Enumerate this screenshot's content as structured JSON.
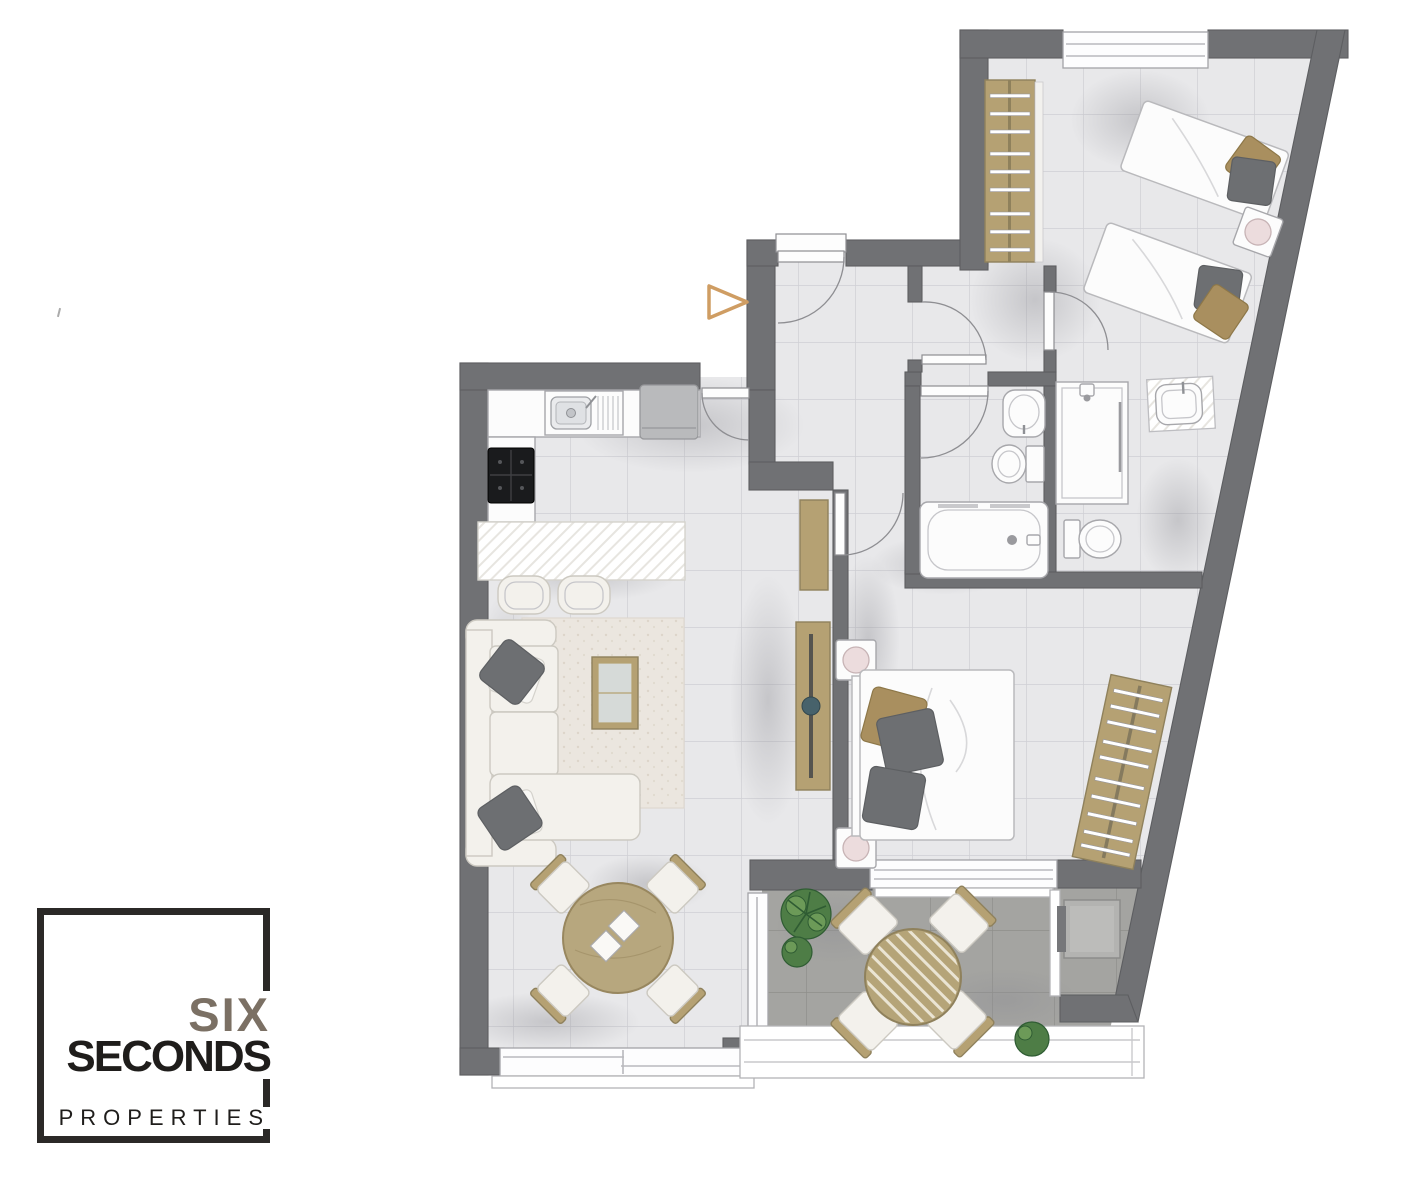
{
  "meta": {
    "width": 1410,
    "height": 1182,
    "background": "#ffffff",
    "kind": "apartment-floor-plan"
  },
  "logo": {
    "six": "SIX",
    "seconds": "SECONDS",
    "properties": "PROPERTIES"
  },
  "palette": {
    "wall": "#707174",
    "wallEdge": "#5d5e61",
    "floor": "#e8e8ea",
    "floorGrout": "#cfcfd4",
    "terraceFloor": "#a4a4a1",
    "terraceGrout": "#8f8f8b",
    "wood": "#b5a173",
    "woodEdge": "#8f815c",
    "fixture": "#fcfcfc",
    "fixtureLine": "#a7a7ab",
    "fabric": "#f3f1ec",
    "fabricLine": "#ccc9c1",
    "pillow": "#6d6f72",
    "pillowTan": "#a98f5f",
    "rug": "#ebe6df",
    "plant": "#4e7d46",
    "plantDark": "#2f5c33",
    "appliance": "#b9babc",
    "hob": "#1a1b1d",
    "lamp": "#ecdcdd",
    "duvetLine": "#d8d8da",
    "shadow": "#8d8d93",
    "arrow": "#cf9d63",
    "logoBorder": "#2b2927",
    "logoSix": "#7b7064",
    "logoText": "#1f1d1b"
  },
  "entrance_marker": {
    "icon": "triangle-right-icon",
    "color": "#cf9d63"
  },
  "rooms": [
    {
      "name": "kitchen"
    },
    {
      "name": "living-dining-room"
    },
    {
      "name": "corridor"
    },
    {
      "name": "entrance-vestibule"
    },
    {
      "name": "twin-bedroom"
    },
    {
      "name": "master-bedroom"
    },
    {
      "name": "bathroom-1"
    },
    {
      "name": "bathroom-2"
    },
    {
      "name": "terrace"
    }
  ],
  "furniture_legend": [
    {
      "name": "kitchen-sink",
      "shape": "basin-with-drainer"
    },
    {
      "name": "refrigerator",
      "shape": "gray-rect"
    },
    {
      "name": "cooktop",
      "shape": "black-rect-4-burners"
    },
    {
      "name": "kitchen-island",
      "shape": "white-hatched-rect"
    },
    {
      "name": "bar-stool",
      "count": 2
    },
    {
      "name": "sofa",
      "shape": "l-shaped-chaise"
    },
    {
      "name": "throw-pillow",
      "count": 4
    },
    {
      "name": "rug",
      "shape": "speckled-rect"
    },
    {
      "name": "coffee-table",
      "shape": "wood-frame-glass-top"
    },
    {
      "name": "dining-table",
      "shape": "round-wood",
      "chairs": 4
    },
    {
      "name": "console-table",
      "count": 2
    },
    {
      "name": "double-bed",
      "nightstands": 2,
      "lamps": 2
    },
    {
      "name": "twin-bed",
      "count": 2,
      "nightstands": 1,
      "lamps": 1
    },
    {
      "name": "wardrobe",
      "count": 2,
      "shape": "wood-with-hanger-rails"
    },
    {
      "name": "bathtub",
      "count": 1
    },
    {
      "name": "toilet",
      "count": 2
    },
    {
      "name": "washbasin",
      "count": 3
    },
    {
      "name": "shower",
      "count": 1
    },
    {
      "name": "terrace-table",
      "shape": "round-wood-slats",
      "chairs": 4
    },
    {
      "name": "plant",
      "count": 3
    },
    {
      "name": "ac-unit",
      "count": 1
    },
    {
      "name": "balcony-railing",
      "count": 1
    }
  ]
}
